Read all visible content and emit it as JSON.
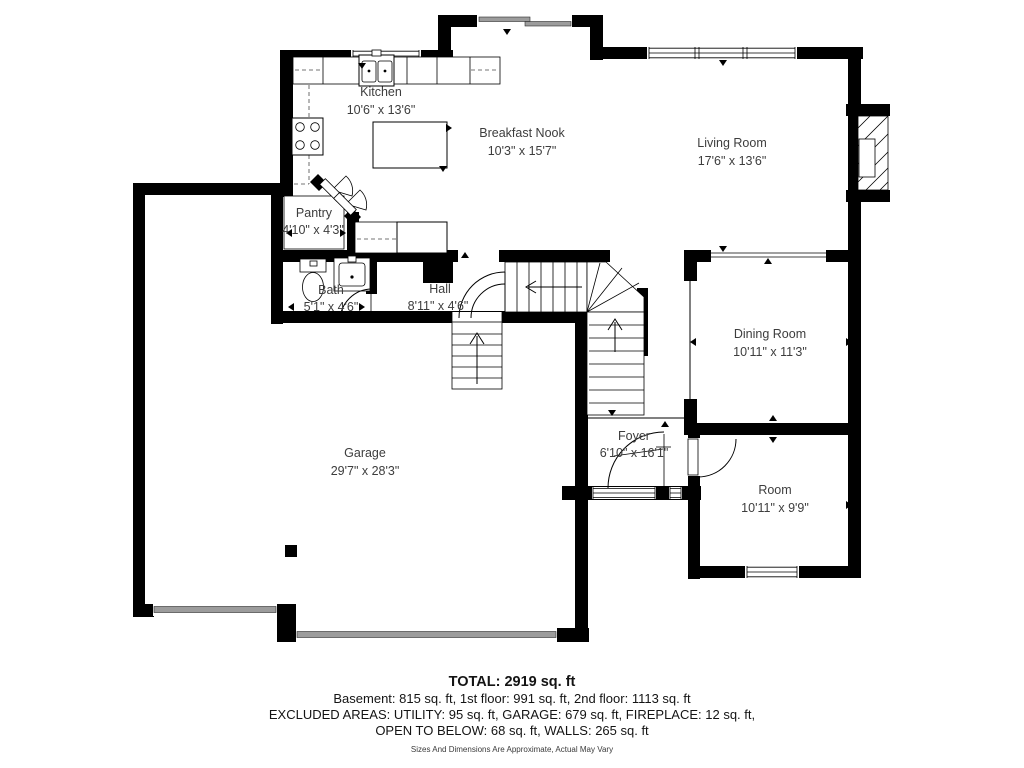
{
  "floor_plan": {
    "rooms": [
      {
        "name": "Kitchen",
        "dims": "10'6\" x 13'6\""
      },
      {
        "name": "Breakfast Nook",
        "dims": "10'3\" x 15'7\""
      },
      {
        "name": "Living Room",
        "dims": "17'6\" x 13'6\""
      },
      {
        "name": "Pantry",
        "dims": "4'10\" x 4'3\""
      },
      {
        "name": "Bath",
        "dims": "5'1\" x 4'6\""
      },
      {
        "name": "Hall",
        "dims": "8'11\" x 4'6\""
      },
      {
        "name": "Dining Room",
        "dims": "10'11\" x 11'3\""
      },
      {
        "name": "Foyer",
        "dims": "6'10\" x 16'1\""
      },
      {
        "name": "Garage",
        "dims": "29'7\" x 28'3\""
      },
      {
        "name": "Room",
        "dims": "10'11\" x 9'9\""
      }
    ],
    "footer": {
      "total": "TOTAL: 2919 sq. ft",
      "line1": "Basement: 815 sq. ft, 1st floor: 991 sq. ft, 2nd floor: 1113 sq. ft",
      "line2": "EXCLUDED AREAS: UTILITY: 95 sq. ft, GARAGE: 679 sq. ft, FIREPLACE: 12 sq. ft,",
      "line3": "OPEN TO BELOW: 68 sq. ft, WALLS: 265 sq. ft",
      "disclaimer": "Sizes And Dimensions Are Approximate, Actual May Vary"
    },
    "colors": {
      "wall": "#000000",
      "garage_door": "#9c9c9c",
      "label": "#3d3d3d"
    }
  }
}
